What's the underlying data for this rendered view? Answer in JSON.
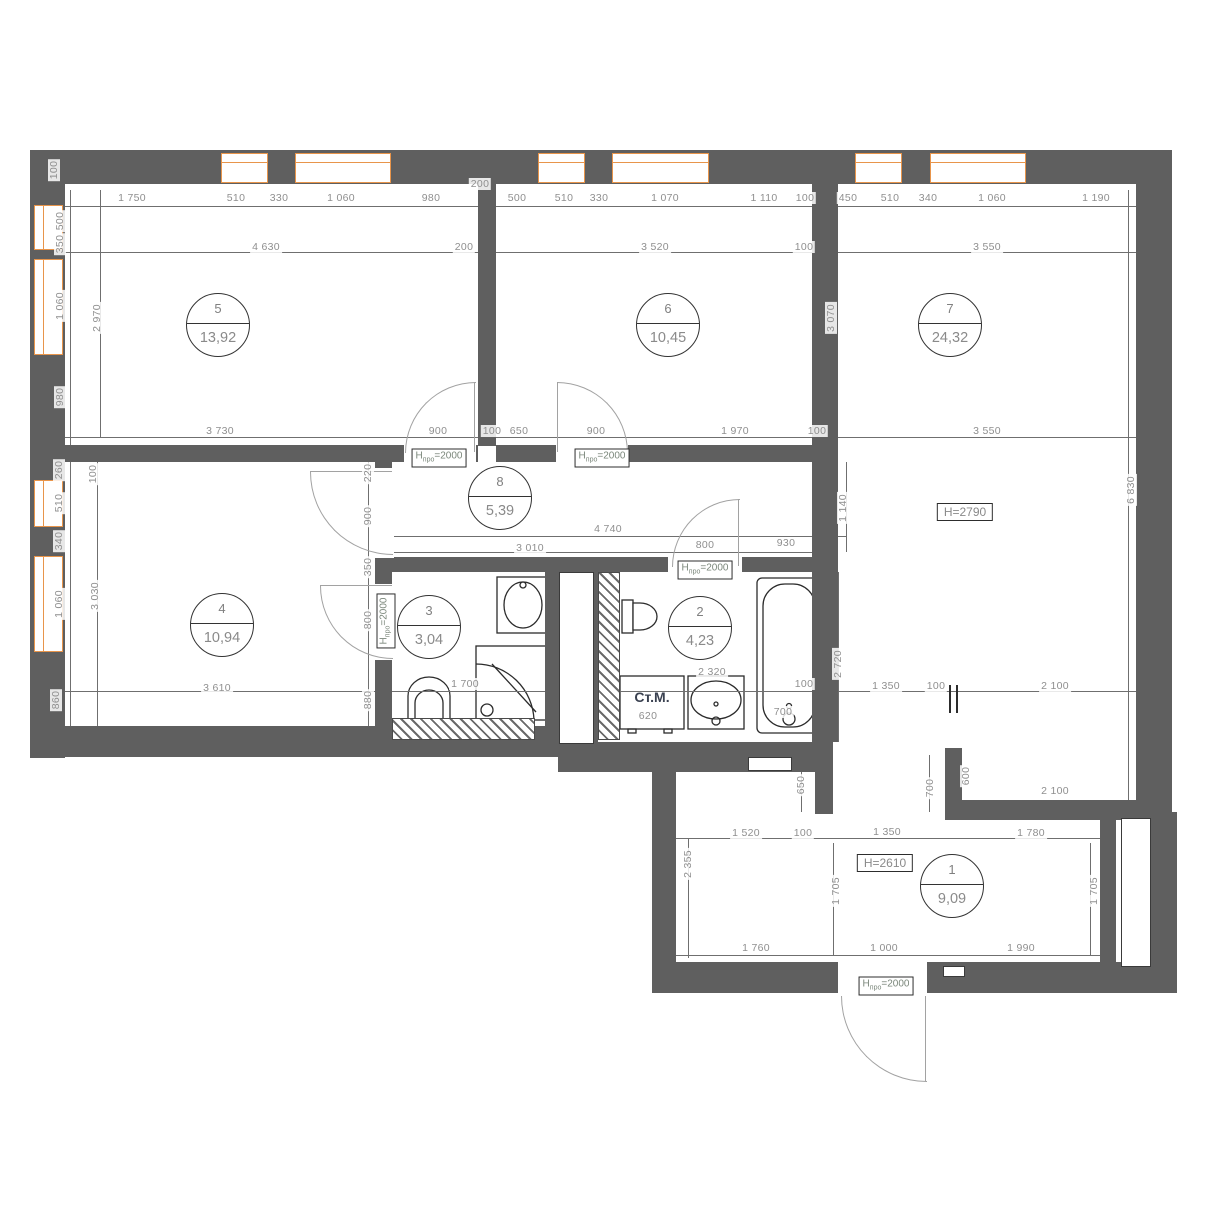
{
  "title": "apartment-floor-plan",
  "appliance": {
    "label": "Ст.М."
  },
  "door_height_label": {
    "main": "H",
    "sub": "про",
    "rest": "=2000"
  },
  "height_boxes": [
    {
      "text": "H=2790",
      "x": 965,
      "y": 512
    },
    {
      "text": "H=2610",
      "x": 885,
      "y": 863
    }
  ],
  "door_height_boxes": [
    {
      "x": 439,
      "y": 458,
      "v": false
    },
    {
      "x": 602,
      "y": 458,
      "v": false
    },
    {
      "x": 705,
      "y": 570,
      "v": false
    },
    {
      "x": 886,
      "y": 986,
      "v": false
    },
    {
      "x": 386,
      "y": 621,
      "v": true
    }
  ],
  "rooms": [
    {
      "num": "1",
      "area": "9,09",
      "x": 952,
      "y": 886
    },
    {
      "num": "2",
      "area": "4,23",
      "x": 700,
      "y": 628
    },
    {
      "num": "3",
      "area": "3,04",
      "x": 429,
      "y": 627
    },
    {
      "num": "4",
      "area": "10,94",
      "x": 222,
      "y": 625
    },
    {
      "num": "5",
      "area": "13,92",
      "x": 218,
      "y": 325
    },
    {
      "num": "6",
      "area": "10,45",
      "x": 668,
      "y": 325
    },
    {
      "num": "7",
      "area": "24,32",
      "x": 950,
      "y": 325
    },
    {
      "num": "8",
      "area": "5,39",
      "x": 500,
      "y": 498
    }
  ],
  "dim_labels": [
    {
      "t": "1 750",
      "x": 132,
      "y": 198
    },
    {
      "t": "510",
      "x": 236,
      "y": 198
    },
    {
      "t": "330",
      "x": 279,
      "y": 198
    },
    {
      "t": "1 060",
      "x": 341,
      "y": 198
    },
    {
      "t": "980",
      "x": 431,
      "y": 198
    },
    {
      "t": "200",
      "x": 480,
      "y": 184
    },
    {
      "t": "500",
      "x": 517,
      "y": 198
    },
    {
      "t": "510",
      "x": 564,
      "y": 198
    },
    {
      "t": "330",
      "x": 599,
      "y": 198
    },
    {
      "t": "1 070",
      "x": 665,
      "y": 198
    },
    {
      "t": "1 110",
      "x": 764,
      "y": 198
    },
    {
      "t": "100",
      "x": 805,
      "y": 198
    },
    {
      "t": "450",
      "x": 848,
      "y": 198
    },
    {
      "t": "510",
      "x": 890,
      "y": 198
    },
    {
      "t": "340",
      "x": 928,
      "y": 198
    },
    {
      "t": "1 060",
      "x": 992,
      "y": 198
    },
    {
      "t": "1 190",
      "x": 1096,
      "y": 198
    },
    {
      "t": "4 630",
      "x": 266,
      "y": 247
    },
    {
      "t": "200",
      "x": 464,
      "y": 247
    },
    {
      "t": "3 520",
      "x": 655,
      "y": 247
    },
    {
      "t": "100",
      "x": 804,
      "y": 247
    },
    {
      "t": "3 550",
      "x": 987,
      "y": 247
    },
    {
      "t": "3 550",
      "x": 987,
      "y": 431
    },
    {
      "t": "100",
      "x": 54,
      "y": 170,
      "v": 1
    },
    {
      "t": "500",
      "x": 60,
      "y": 221,
      "v": 1
    },
    {
      "t": "350",
      "x": 60,
      "y": 244,
      "v": 1
    },
    {
      "t": "1 060",
      "x": 60,
      "y": 306,
      "v": 1
    },
    {
      "t": "980",
      "x": 60,
      "y": 397,
      "v": 1
    },
    {
      "t": "2 970",
      "x": 97,
      "y": 318,
      "v": 1
    },
    {
      "t": "260",
      "x": 59,
      "y": 470,
      "v": 1
    },
    {
      "t": "510",
      "x": 59,
      "y": 503,
      "v": 1
    },
    {
      "t": "340",
      "x": 59,
      "y": 541,
      "v": 1
    },
    {
      "t": "1 060",
      "x": 59,
      "y": 604,
      "v": 1
    },
    {
      "t": "860",
      "x": 56,
      "y": 700,
      "v": 1
    },
    {
      "t": "100",
      "x": 93,
      "y": 474,
      "v": 1
    },
    {
      "t": "3 030",
      "x": 95,
      "y": 596,
      "v": 1
    },
    {
      "t": "220",
      "x": 368,
      "y": 473,
      "v": 1
    },
    {
      "t": "900",
      "x": 368,
      "y": 516,
      "v": 1
    },
    {
      "t": "350",
      "x": 368,
      "y": 567,
      "v": 1
    },
    {
      "t": "800",
      "x": 368,
      "y": 620,
      "v": 1
    },
    {
      "t": "880",
      "x": 368,
      "y": 700,
      "v": 1
    },
    {
      "t": "3 730",
      "x": 220,
      "y": 431
    },
    {
      "t": "900",
      "x": 438,
      "y": 431
    },
    {
      "t": "100",
      "x": 492,
      "y": 431
    },
    {
      "t": "650",
      "x": 519,
      "y": 431
    },
    {
      "t": "900",
      "x": 596,
      "y": 431
    },
    {
      "t": "1 970",
      "x": 735,
      "y": 431
    },
    {
      "t": "100",
      "x": 817,
      "y": 431
    },
    {
      "t": "4 740",
      "x": 608,
      "y": 529
    },
    {
      "t": "3 010",
      "x": 530,
      "y": 548
    },
    {
      "t": "800",
      "x": 705,
      "y": 545
    },
    {
      "t": "930",
      "x": 786,
      "y": 543
    },
    {
      "t": "1 140",
      "x": 843,
      "y": 508,
      "v": 1
    },
    {
      "t": "2 720",
      "x": 838,
      "y": 664,
      "v": 1
    },
    {
      "t": "3 070",
      "x": 831,
      "y": 318,
      "v": 1
    },
    {
      "t": "6 830",
      "x": 1131,
      "y": 490,
      "v": 1
    },
    {
      "t": "3 610",
      "x": 217,
      "y": 688
    },
    {
      "t": "1 700",
      "x": 465,
      "y": 684
    },
    {
      "t": "2 320",
      "x": 712,
      "y": 672
    },
    {
      "t": "100",
      "x": 804,
      "y": 684
    },
    {
      "t": "1 350",
      "x": 886,
      "y": 686
    },
    {
      "t": "100",
      "x": 936,
      "y": 686
    },
    {
      "t": "2 100",
      "x": 1055,
      "y": 686
    },
    {
      "t": "620",
      "x": 648,
      "y": 716
    },
    {
      "t": "700",
      "x": 783,
      "y": 712
    },
    {
      "t": "650",
      "x": 801,
      "y": 785,
      "v": 1
    },
    {
      "t": "700",
      "x": 930,
      "y": 788,
      "v": 1
    },
    {
      "t": "600",
      "x": 966,
      "y": 776,
      "v": 1
    },
    {
      "t": "2 100",
      "x": 1055,
      "y": 791
    },
    {
      "t": "2 355",
      "x": 688,
      "y": 864,
      "v": 1
    },
    {
      "t": "1 520",
      "x": 746,
      "y": 833
    },
    {
      "t": "100",
      "x": 803,
      "y": 833
    },
    {
      "t": "1 350",
      "x": 887,
      "y": 832
    },
    {
      "t": "1 780",
      "x": 1031,
      "y": 833
    },
    {
      "t": "1 705",
      "x": 836,
      "y": 891,
      "v": 1
    },
    {
      "t": "1 705",
      "x": 1094,
      "y": 891,
      "v": 1
    },
    {
      "t": "1 760",
      "x": 756,
      "y": 948
    },
    {
      "t": "1 000",
      "x": 884,
      "y": 948
    },
    {
      "t": "1 990",
      "x": 1021,
      "y": 948
    }
  ],
  "colors": {
    "wall": "#5f5f5f",
    "window": "#e8954b",
    "dim_text": "#8f8f8f",
    "dim_line": "#6f6f6f",
    "fixture": "#2b2b2b",
    "door_arc": "#a2a2a2",
    "appliance_text": "#3a4150"
  }
}
